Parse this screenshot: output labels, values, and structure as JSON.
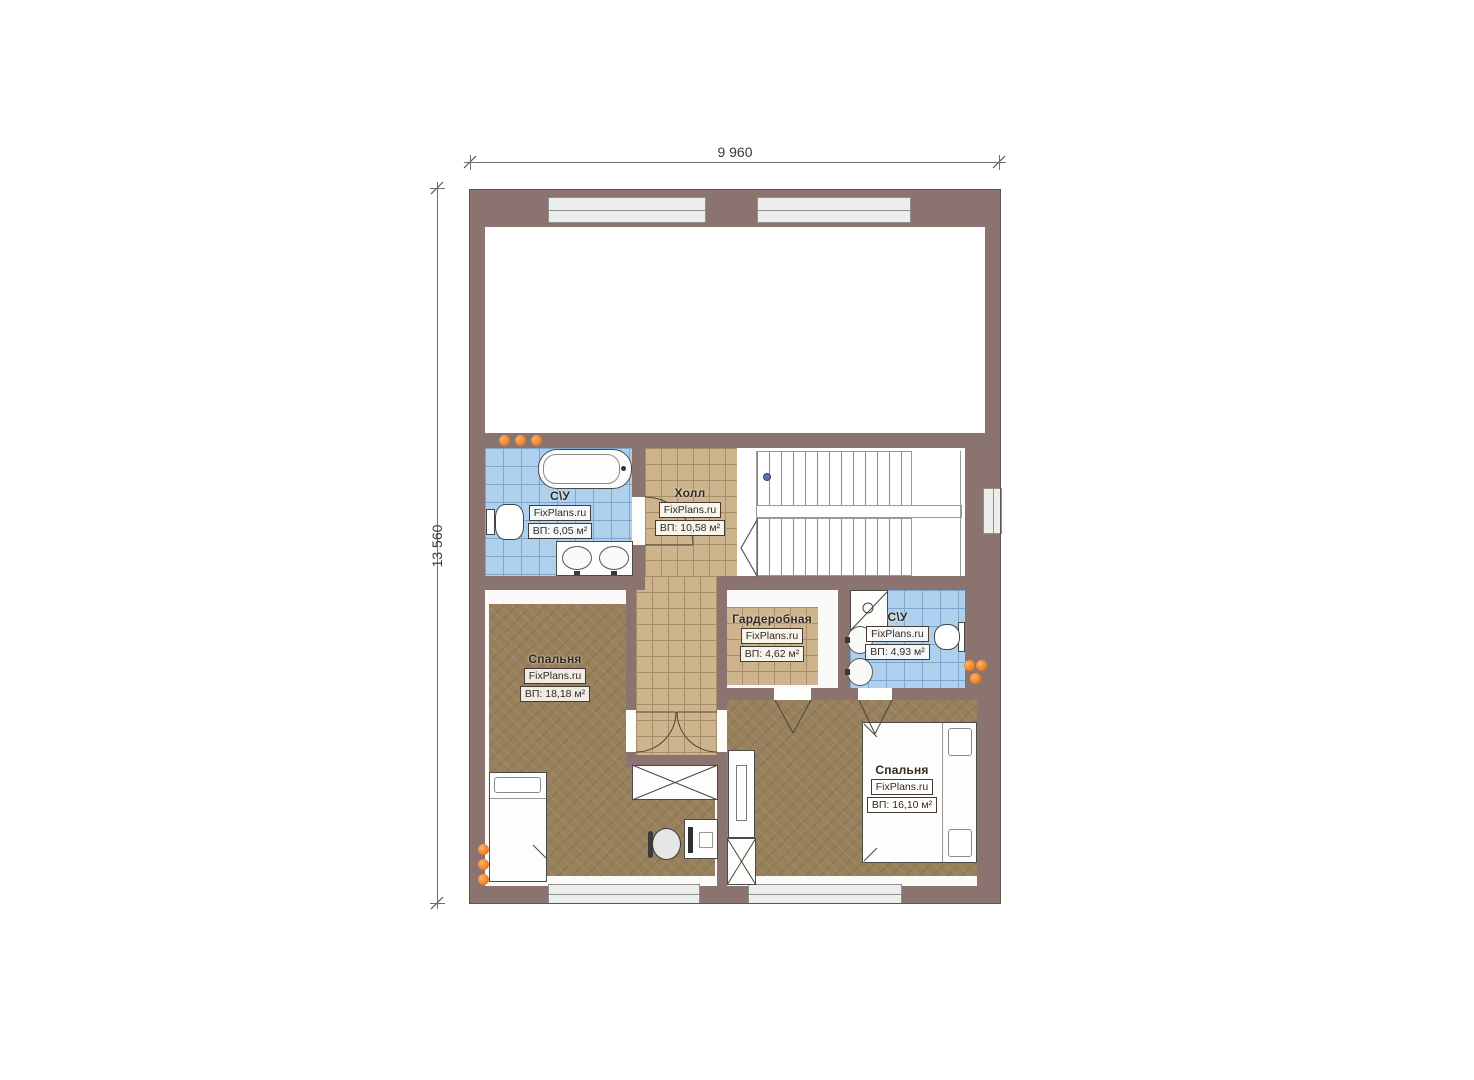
{
  "plan": {
    "dimensions": {
      "top": "9 960",
      "left": "13 560"
    },
    "rooms": [
      {
        "key": "bathroom-top",
        "name": "С\\У",
        "brand": "FixPlans.ru",
        "area": "ВП: 6,05 м²"
      },
      {
        "key": "hall",
        "name": "Холл",
        "brand": "FixPlans.ru",
        "area": "ВП: 10,58 м²"
      },
      {
        "key": "bedroom-left",
        "name": "Спальня",
        "brand": "FixPlans.ru",
        "area": "ВП: 18,18 м²"
      },
      {
        "key": "wardrobe",
        "name": "Гардеробная",
        "brand": "FixPlans.ru",
        "area": "ВП: 4,62 м²"
      },
      {
        "key": "bathroom-right",
        "name": "С\\У",
        "brand": "FixPlans.ru",
        "area": "ВП: 4,93 м²"
      },
      {
        "key": "bedroom-right",
        "name": "Спальня",
        "brand": "FixPlans.ru",
        "area": "ВП: 16,10 м²"
      }
    ],
    "colors": {
      "wall": "#8b7470",
      "tile_blue": "#aed0ec",
      "tile_blue_grid": "#7fa6cf",
      "tile_tan": "#cdb48d",
      "tile_tan_grid": "#a78e69",
      "carpet": "#97805b",
      "radiator": "#e8751a",
      "window": "#eceeeb",
      "stair_marker": "#5f6fb5"
    }
  }
}
